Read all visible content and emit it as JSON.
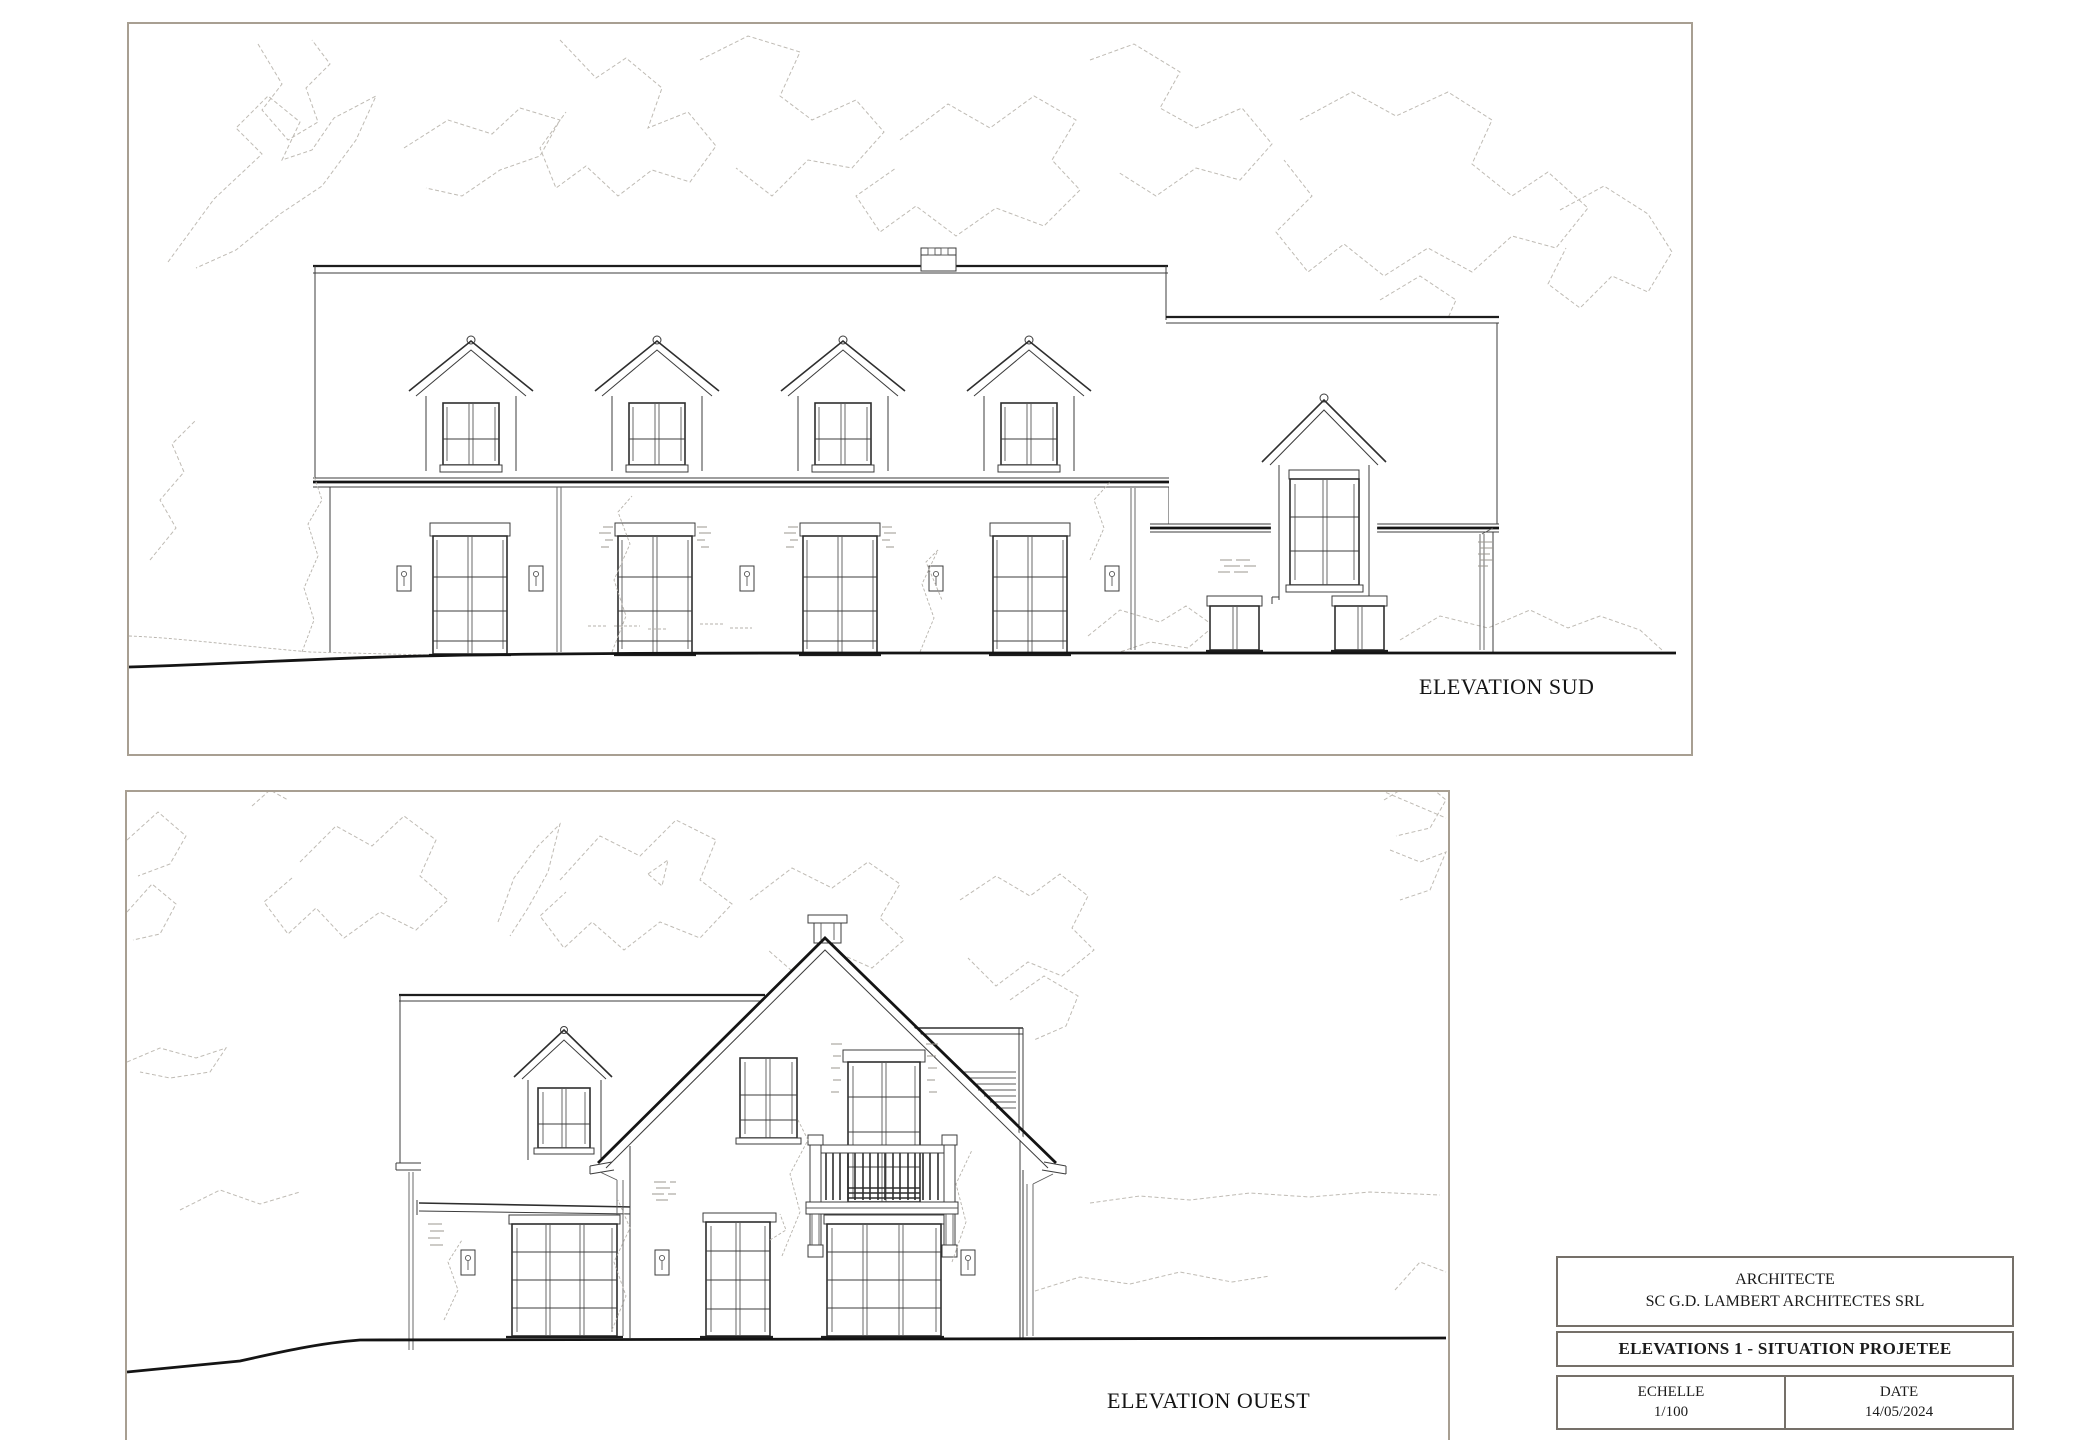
{
  "panels": {
    "south": {
      "label": "ELEVATION SUD"
    },
    "west": {
      "label": "ELEVATION OUEST"
    }
  },
  "title_block": {
    "architect_label": "ARCHITECTE",
    "architect_name": "SC G.D. LAMBERT ARCHITECTES SRL",
    "sheet_title": "ELEVATIONS 1 - SITUATION PROJETEE",
    "scale_label": "ECHELLE",
    "scale_value": "1/100",
    "date_label": "DATE",
    "date_value": "14/05/2024"
  },
  "colors": {
    "paper": "#ffffff",
    "panel_border": "#a89f92",
    "titleblock_border": "#757069",
    "drawing_line": "#3c3c3c",
    "heavy_line": "#141414",
    "tree_line": "#bfbbb4"
  }
}
